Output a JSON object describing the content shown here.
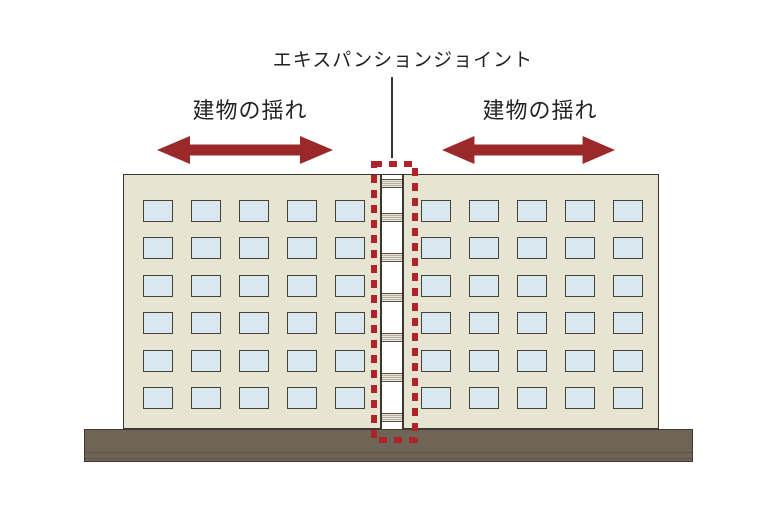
{
  "title": "エキスパンションジョイント",
  "sway_labels": {
    "left": "建物の揺れ",
    "right": "建物の揺れ"
  },
  "colors": {
    "background": "#ffffff",
    "text": "#222222",
    "arrow": "#9b2929",
    "dashed_outline": "#b1232a",
    "building_fill": "#e7e4d1",
    "building_border": "#3c372e",
    "window_fill": "#d9e7f1",
    "window_border": "#46423a",
    "joint_fill": "#ffffff",
    "ground": "#6f6557"
  },
  "diagram": {
    "building_count": 2,
    "window_rows": 6,
    "window_cols": 5,
    "joint_band_count": 7
  }
}
